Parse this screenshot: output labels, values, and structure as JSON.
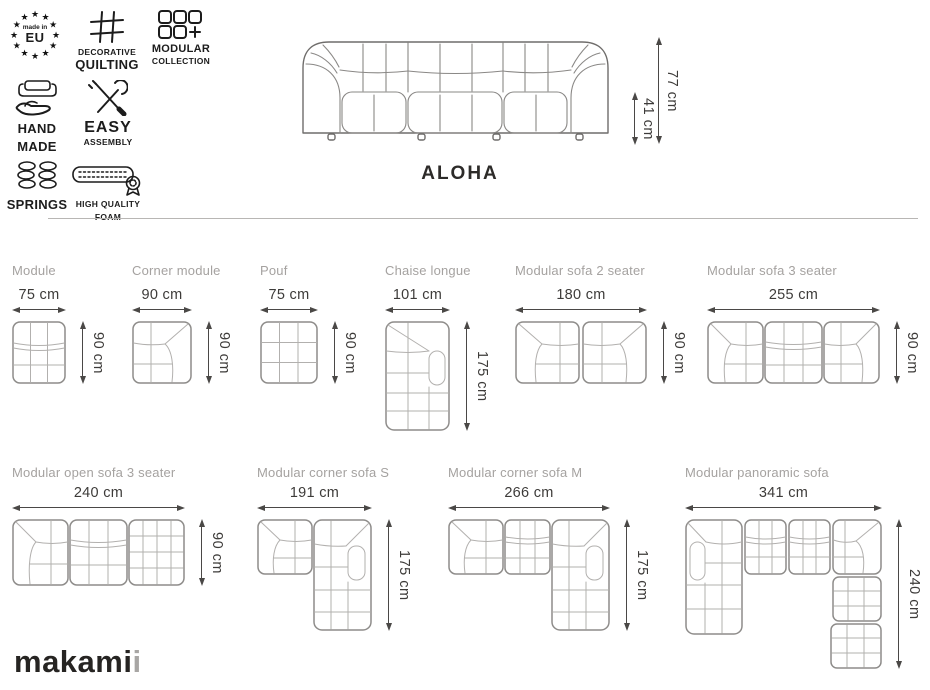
{
  "badges": [
    {
      "id": "made-in-eu",
      "line1": "made in",
      "line2": "EU"
    },
    {
      "id": "decorative-quilting",
      "line1": "DECORATIVE",
      "line2": "QUILTING"
    },
    {
      "id": "modular-collection",
      "line1": "MODULAR",
      "line2": "COLLECTION"
    },
    {
      "id": "hand-made",
      "line1": "HAND",
      "line2": "MADE"
    },
    {
      "id": "easy-assembly",
      "line1": "EASY",
      "line2": "ASSEMBLY"
    },
    {
      "id": "springs",
      "line1": "SPRINGS"
    },
    {
      "id": "high-quality-foam",
      "line1": "HIGH QUALITY",
      "line2": "FOAM"
    }
  ],
  "icons": {
    "star": "★"
  },
  "hero": {
    "name": "ALOHA",
    "total_height": "77 cm",
    "seat_height": "41 cm"
  },
  "products": [
    {
      "name": "Module",
      "width": "75 cm",
      "height": "90 cm"
    },
    {
      "name": "Corner module",
      "width": "90 cm",
      "height": "90 cm"
    },
    {
      "name": "Pouf",
      "width": "75 cm",
      "height": "90 cm"
    },
    {
      "name": "Chaise longue",
      "width": "101 cm",
      "height": "175 cm"
    },
    {
      "name": "Modular sofa 2 seater",
      "width": "180 cm",
      "height": "90 cm"
    },
    {
      "name": "Modular sofa 3 seater",
      "width": "255 cm",
      "height": "90 cm"
    },
    {
      "name": "Modular open sofa 3 seater",
      "width": "240 cm",
      "height": "90 cm"
    },
    {
      "name": "Modular corner sofa S",
      "width": "191 cm",
      "height": "175 cm"
    },
    {
      "name": "Modular corner sofa M",
      "width": "266 cm",
      "height": "175 cm"
    },
    {
      "name": "Modular panoramic sofa",
      "width": "341 cm",
      "height": "240 cm"
    }
  ],
  "logo": {
    "main": "makami",
    "accent": "i"
  },
  "colors": {
    "title_gray": "#a5a2a0",
    "dimension_text": "#3d3b39",
    "drawing_line": "#8e8c8a",
    "ink": "#1c1c1c"
  }
}
